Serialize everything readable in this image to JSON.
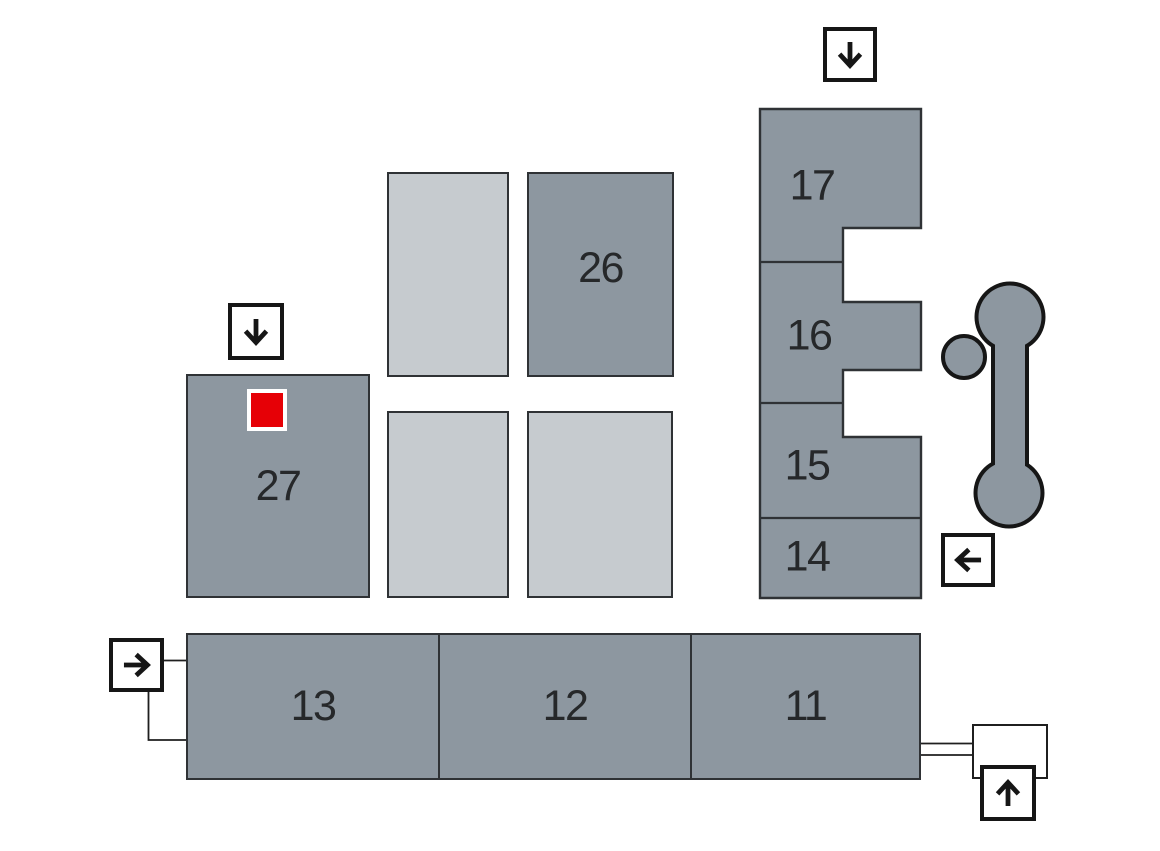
{
  "map": {
    "name": "exhibition-grounds-hall-plan",
    "halls": [
      {
        "id": "11",
        "label": "11"
      },
      {
        "id": "12",
        "label": "12"
      },
      {
        "id": "13",
        "label": "13"
      },
      {
        "id": "14",
        "label": "14"
      },
      {
        "id": "15",
        "label": "15"
      },
      {
        "id": "16",
        "label": "16"
      },
      {
        "id": "17",
        "label": "17"
      },
      {
        "id": "26",
        "label": "26"
      },
      {
        "id": "27",
        "label": "27"
      }
    ],
    "unlabeled_building_count": 3,
    "entrances": [
      {
        "position": "top-right",
        "icon": "down-arrow-icon"
      },
      {
        "position": "above-hall-27",
        "icon": "down-arrow-icon"
      },
      {
        "position": "right-of-hall-14",
        "icon": "left-arrow-icon"
      },
      {
        "position": "left-of-hall-13",
        "icon": "right-arrow-icon"
      },
      {
        "position": "bottom-right",
        "icon": "up-arrow-icon"
      }
    ],
    "marker": {
      "located_in_hall": "27",
      "color": "#e60006"
    },
    "landmark": "tower-dumbbell-shape",
    "colors": {
      "hall_fill": "#8d97a0",
      "secondary_building_fill": "#c6cbcf",
      "outline": "#2f3235",
      "icon_black": "#161616",
      "marker_red": "#e60006",
      "background": "#ffffff"
    }
  }
}
